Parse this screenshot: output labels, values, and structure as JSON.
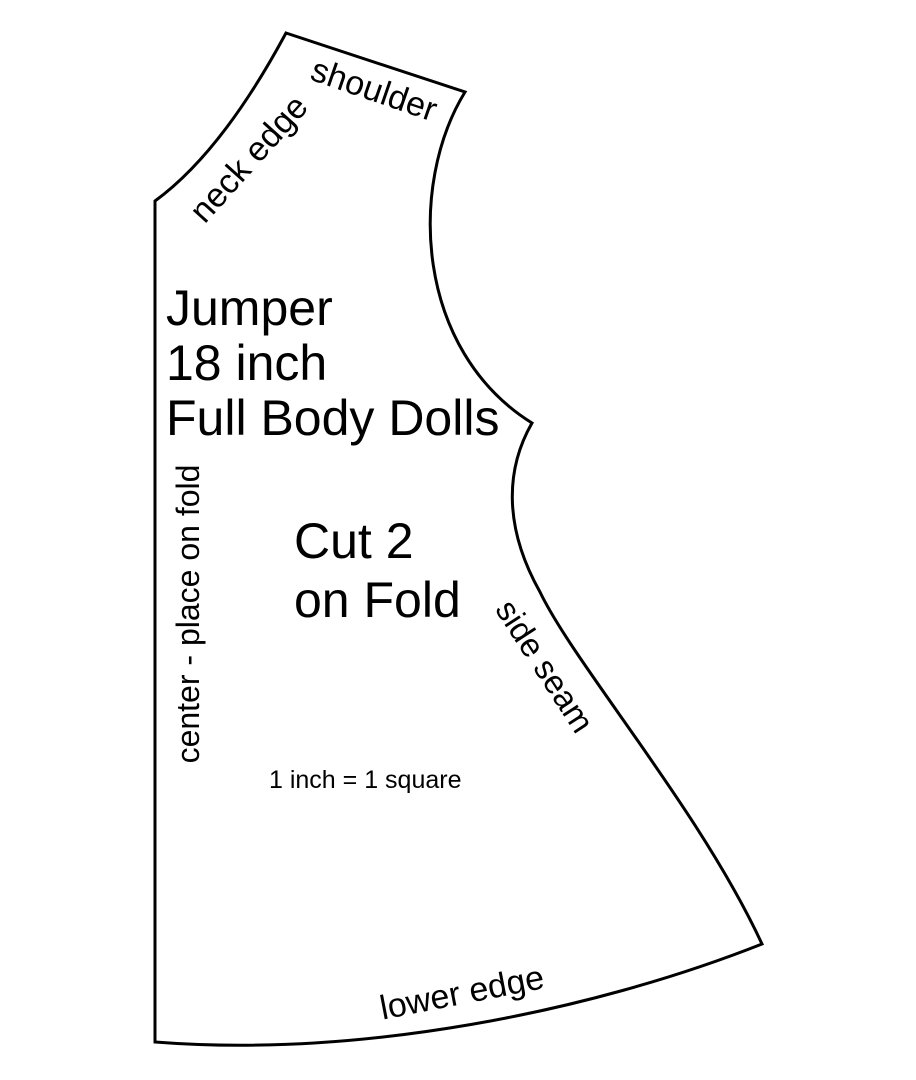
{
  "pattern": {
    "title_lines": [
      "Jumper",
      "18 inch",
      "Full Body Dolls"
    ],
    "cut_lines": [
      "Cut 2",
      "on Fold"
    ],
    "scale_note": "1 inch = 1 square",
    "edge_labels": {
      "shoulder": "shoulder",
      "neck_edge": "neck edge",
      "side_seam": "side seam",
      "lower_edge": "lower edge",
      "center_fold": "center - place on fold"
    },
    "colors": {
      "outline": "#000000",
      "text": "#000000",
      "background": "#ffffff"
    }
  }
}
